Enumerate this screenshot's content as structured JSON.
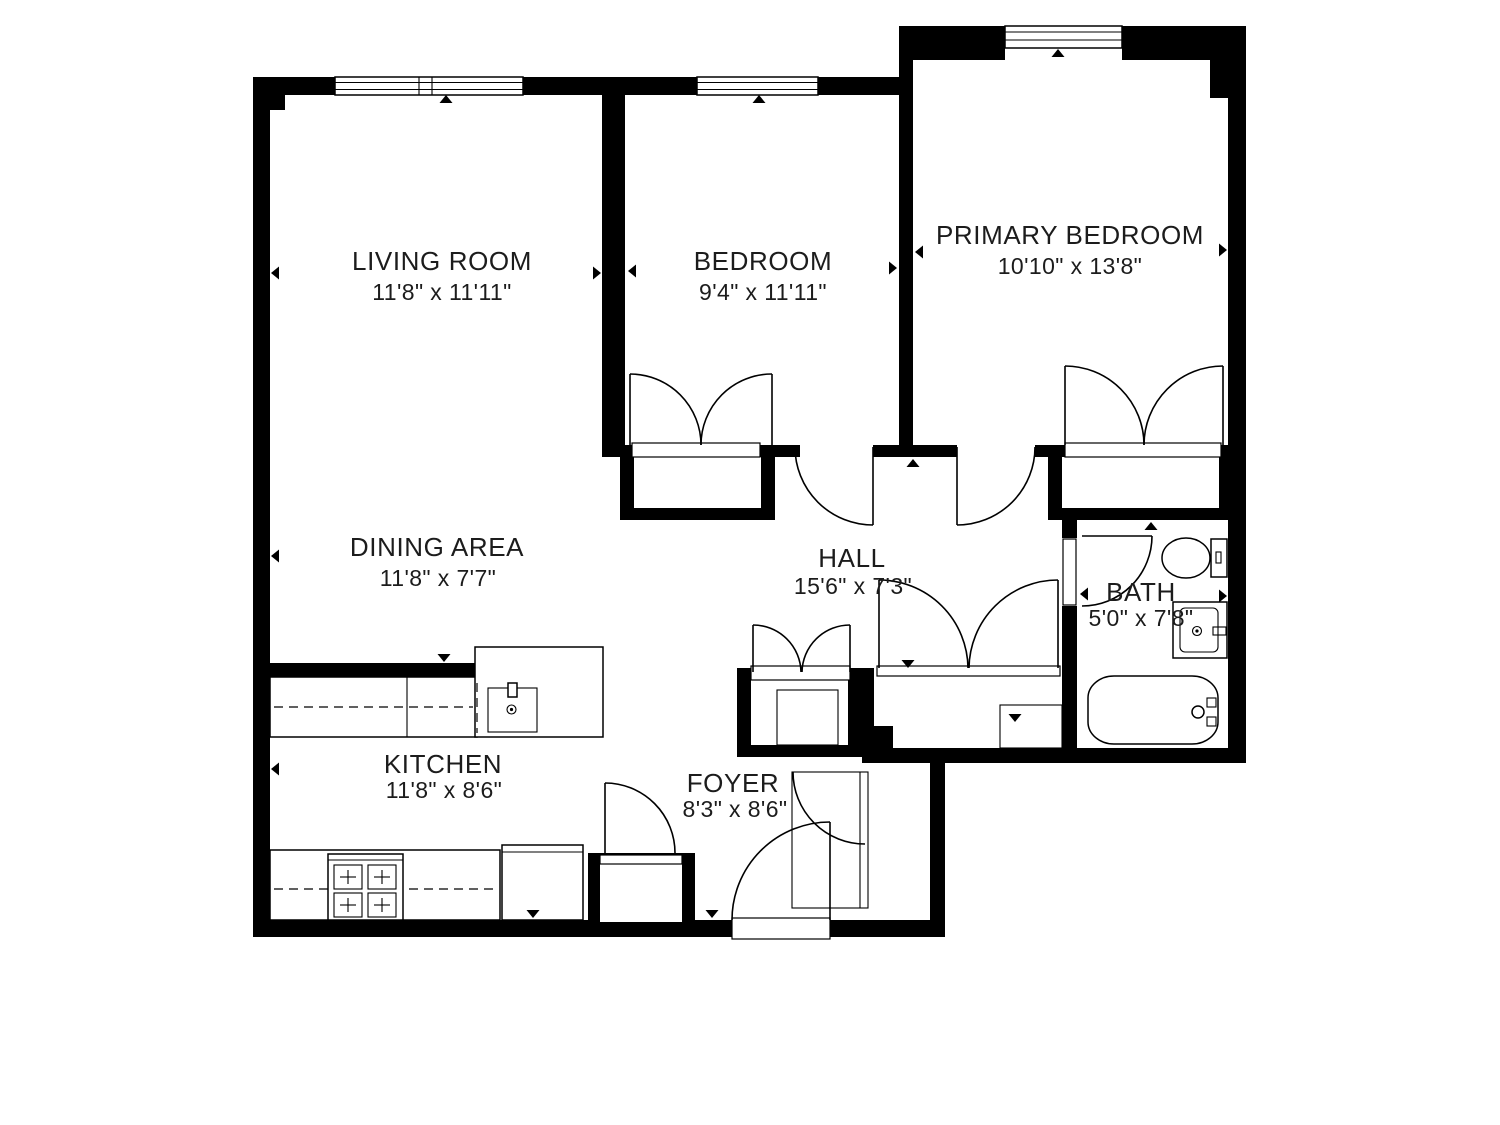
{
  "plan": {
    "background": "#ffffff",
    "wall_color": "#000000",
    "text_color": "#1c1c1c"
  },
  "rooms": [
    {
      "id": "living-room",
      "name": "LIVING ROOM",
      "dims": "11'8\" x 11'11\""
    },
    {
      "id": "bedroom",
      "name": "BEDROOM",
      "dims": "9'4\" x 11'11\""
    },
    {
      "id": "primary-bedroom",
      "name": "PRIMARY BEDROOM",
      "dims": "10'10\" x 13'8\""
    },
    {
      "id": "dining-area",
      "name": "DINING AREA",
      "dims": "11'8\" x 7'7\""
    },
    {
      "id": "hall",
      "name": "HALL",
      "dims": "15'6\" x 7'3\""
    },
    {
      "id": "bath",
      "name": "BATH",
      "dims": "5'0\" x 7'8\""
    },
    {
      "id": "kitchen",
      "name": "KITCHEN",
      "dims": "11'8\" x 8'6\""
    },
    {
      "id": "foyer",
      "name": "FOYER",
      "dims": "8'3\" x 8'6\""
    }
  ],
  "fixtures": [
    "window",
    "door",
    "closet",
    "bifold-closet",
    "toilet",
    "vanity-sink",
    "bathtub",
    "kitchen-island-sink",
    "stove",
    "refrigerator",
    "counter"
  ]
}
